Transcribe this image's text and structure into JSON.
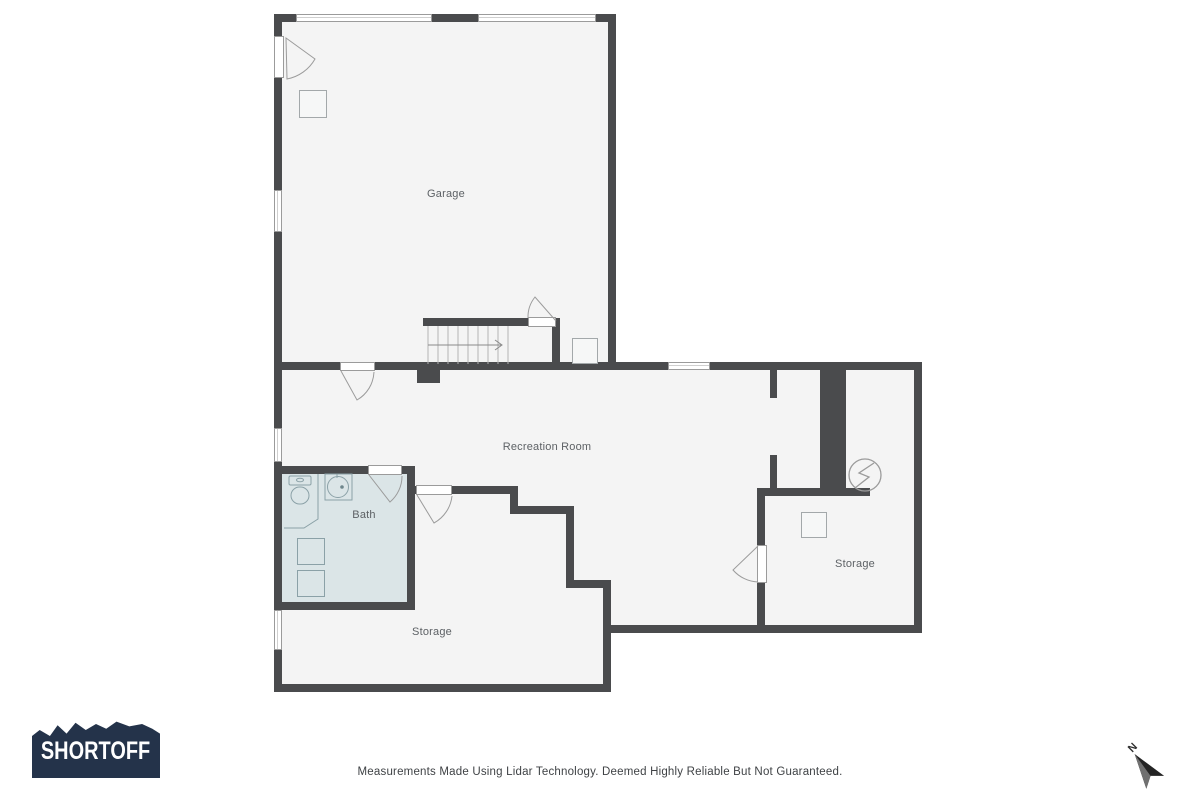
{
  "logo": {
    "text": "SHORTOFF",
    "bg_color": "#24334a",
    "text_color": "#ffffff"
  },
  "footer": {
    "disclaimer": "Measurements Made Using Lidar Technology. Deemed Highly Reliable But Not Guaranteed."
  },
  "compass": {
    "label": "N"
  },
  "colors": {
    "wall": "#4a4b4d",
    "room_fill": "#f4f4f4",
    "bath_fill": "#dbe5e7",
    "window_border": "#9b9b9b",
    "fixture_stroke": "#9da2a5",
    "bath_fixture_stroke": "#8ba1a7",
    "label_text": "#5d6165"
  },
  "rooms": [
    {
      "id": "garage",
      "label": "Garage"
    },
    {
      "id": "recreation-room",
      "label": "Recreation Room"
    },
    {
      "id": "bath",
      "label": "Bath"
    },
    {
      "id": "storage-right",
      "label": "Storage"
    },
    {
      "id": "storage-bottom",
      "label": "Storage"
    }
  ],
  "fixtures": [
    "toilet",
    "sink",
    "washer",
    "dryer",
    "electrical-panel",
    "staircase-up-arrow",
    "garage-column",
    "water-heater",
    "storage-cabinet"
  ]
}
